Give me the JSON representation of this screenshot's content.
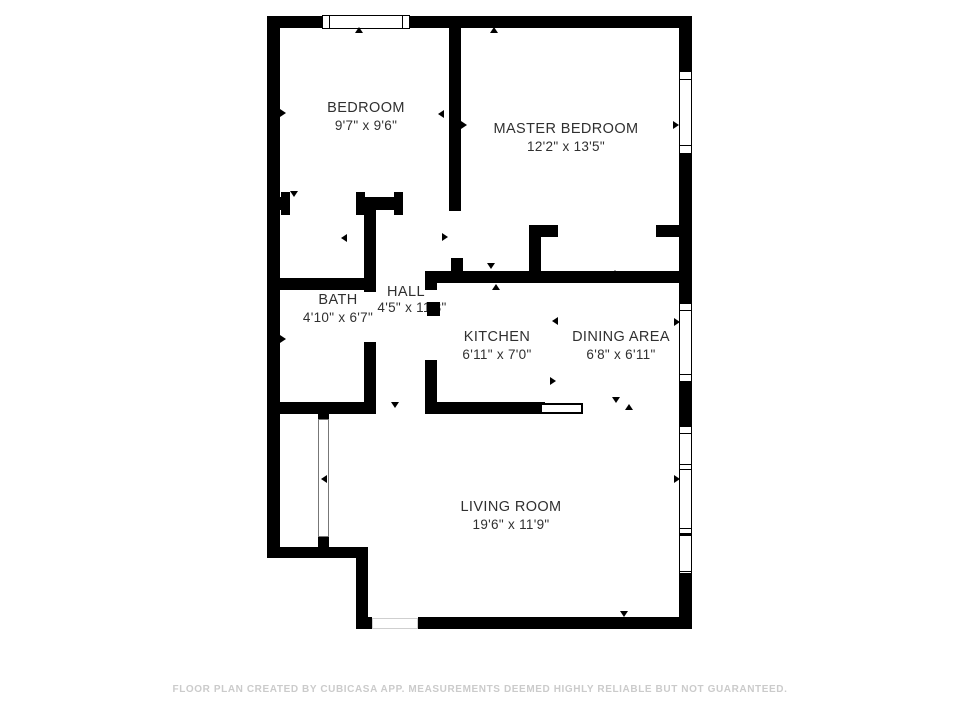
{
  "floor_plan": {
    "rooms": {
      "bedroom": {
        "label": "BEDROOM",
        "dims": "9'7\" x 9'6\""
      },
      "master_bedroom": {
        "label": "MASTER BEDROOM",
        "dims": "12'2\" x 13'5\""
      },
      "bath": {
        "label": "BATH",
        "dims": "4'10\" x 6'7\""
      },
      "hall": {
        "label": "HALL",
        "dims": "4'5\" x 11'8\""
      },
      "kitchen": {
        "label": "KITCHEN",
        "dims": "6'11\" x 7'0\""
      },
      "dining_area": {
        "label": "DINING AREA",
        "dims": "6'8\" x 6'11\""
      },
      "living_room": {
        "label": "LIVING ROOM",
        "dims": "19'6\" x 11'9\""
      }
    },
    "footer": "FLOOR PLAN CREATED BY CUBICASA APP. MEASUREMENTS DEEMED HIGHLY RELIABLE BUT NOT GUARANTEED.",
    "colors": {
      "wall": "#000000",
      "background": "#ffffff",
      "label_text": "#303030",
      "footer_text": "#cbcbcb"
    }
  }
}
